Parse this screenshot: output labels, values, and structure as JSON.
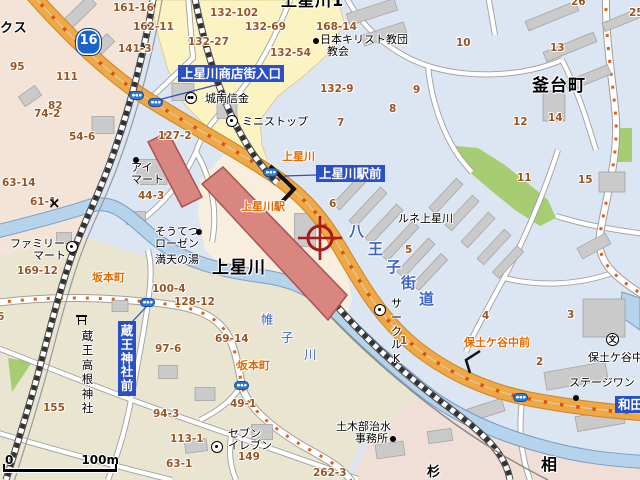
{
  "map": {
    "route_shield": {
      "number": "16"
    },
    "scale_bar": {
      "start": "0",
      "distance": "100m"
    },
    "place_names": [
      {
        "t": "上星川1",
        "x": 281,
        "y": -7,
        "fs": 16,
        "n": "place-kamihoshikawa-1"
      },
      {
        "t": "釜台町",
        "x": 532,
        "y": 78,
        "fs": 17,
        "n": "place-kamadaicho"
      },
      {
        "t": "上星川",
        "x": 212,
        "y": 260,
        "fs": 17,
        "n": "place-kamihoshikawa"
      },
      {
        "t": "相",
        "x": 541,
        "y": 457,
        "fs": 16,
        "n": "place-ai-partial"
      },
      {
        "t": "杉",
        "x": 427,
        "y": 466,
        "fs": 13,
        "n": "place-sugi-partial"
      },
      {
        "t": "クス",
        "x": 0,
        "y": 22,
        "fs": 13,
        "n": "place-kusu-partial"
      }
    ],
    "district_numbers": [
      {
        "t": "161-16",
        "x": 113,
        "y": 3
      },
      {
        "t": "162-11",
        "x": 133,
        "y": 22
      },
      {
        "t": "141-3",
        "x": 118,
        "y": 44
      },
      {
        "t": "132-102",
        "x": 210,
        "y": 8
      },
      {
        "t": "132-69",
        "x": 245,
        "y": 22
      },
      {
        "t": "132-27",
        "x": 188,
        "y": 37
      },
      {
        "t": "132-54",
        "x": 270,
        "y": 48
      },
      {
        "t": "168-14",
        "x": 316,
        "y": 22
      },
      {
        "t": "132-9",
        "x": 320,
        "y": 84
      },
      {
        "t": "95",
        "x": 10,
        "y": 62
      },
      {
        "t": "111",
        "x": 56,
        "y": 72
      },
      {
        "t": "82",
        "x": 48,
        "y": 101
      },
      {
        "t": "74-2",
        "x": 34,
        "y": 109
      },
      {
        "t": "54-6",
        "x": 69,
        "y": 132
      },
      {
        "t": "127-2",
        "x": 158,
        "y": 131
      },
      {
        "t": "26",
        "x": 571,
        "y": -3
      },
      {
        "t": "25",
        "x": 629,
        "y": 8
      },
      {
        "t": "10",
        "x": 456,
        "y": 38
      },
      {
        "t": "13",
        "x": 550,
        "y": 43
      },
      {
        "t": "9",
        "x": 413,
        "y": 85
      },
      {
        "t": "8",
        "x": 389,
        "y": 104
      },
      {
        "t": "7",
        "x": 337,
        "y": 118
      },
      {
        "t": "12",
        "x": 513,
        "y": 117
      },
      {
        "t": "14",
        "x": 548,
        "y": 113
      },
      {
        "t": "63-14",
        "x": 2,
        "y": 178
      },
      {
        "t": "44-3",
        "x": 138,
        "y": 191
      },
      {
        "t": "61-1",
        "x": 30,
        "y": 197
      },
      {
        "t": "6",
        "x": 329,
        "y": 199
      },
      {
        "t": "11",
        "x": 517,
        "y": 173
      },
      {
        "t": "15",
        "x": 578,
        "y": 175
      },
      {
        "t": "5",
        "x": 405,
        "y": 245
      },
      {
        "t": "169-12",
        "x": 17,
        "y": 266
      },
      {
        "t": "100-4",
        "x": 152,
        "y": 284
      },
      {
        "t": "128-12",
        "x": 174,
        "y": 297
      },
      {
        "t": "69-14",
        "x": 215,
        "y": 334
      },
      {
        "t": "97-6",
        "x": 155,
        "y": 344
      },
      {
        "t": "6",
        "x": -3,
        "y": 312
      },
      {
        "t": "155",
        "x": 43,
        "y": 403
      },
      {
        "t": "94-3",
        "x": 153,
        "y": 409
      },
      {
        "t": "113-1",
        "x": 170,
        "y": 434
      },
      {
        "t": "63-1",
        "x": 166,
        "y": 459
      },
      {
        "t": "149",
        "x": 238,
        "y": 452
      },
      {
        "t": "49-1",
        "x": 230,
        "y": 399
      },
      {
        "t": "1",
        "x": 400,
        "y": 336
      },
      {
        "t": "4",
        "x": 482,
        "y": 311
      },
      {
        "t": "3",
        "x": 567,
        "y": 310
      },
      {
        "t": "2",
        "x": 536,
        "y": 357
      },
      {
        "t": "262-3",
        "x": 313,
        "y": 468
      }
    ],
    "poi_labels": [
      {
        "t": "日本キリスト教団",
        "x": 320,
        "y": 34,
        "n": "poi-japan-christ-church"
      },
      {
        "t": "教会",
        "x": 327,
        "y": 46,
        "n": "poi-church-line2"
      },
      {
        "t": "城南信金",
        "x": 205,
        "y": 93,
        "n": "poi-jonan-shinkin-bank"
      },
      {
        "t": "ミニストップ",
        "x": 242,
        "y": 116,
        "n": "poi-ministop"
      },
      {
        "t": "アイ",
        "x": 131,
        "y": 162,
        "n": "poi-ai-mart-line1"
      },
      {
        "t": "マート",
        "x": 131,
        "y": 174,
        "n": "poi-ai-mart-line2"
      },
      {
        "t": "そうてつ",
        "x": 155,
        "y": 226,
        "n": "poi-sotetsu-rosen-line1"
      },
      {
        "t": "ローゼン",
        "x": 155,
        "y": 238,
        "n": "poi-sotetsu-rosen-line2"
      },
      {
        "t": "満天の湯",
        "x": 155,
        "y": 254,
        "n": "poi-manten-no-yu"
      },
      {
        "t": "ファミリー",
        "x": 10,
        "y": 238,
        "n": "poi-familymart-line1"
      },
      {
        "t": "マート",
        "x": 33,
        "y": 250,
        "n": "poi-familymart-line2"
      },
      {
        "t": "セブン",
        "x": 228,
        "y": 428,
        "n": "poi-seven-eleven-line1"
      },
      {
        "t": "イレブン",
        "x": 228,
        "y": 440,
        "n": "poi-seven-eleven-line2"
      },
      {
        "t": "ルネ上星川",
        "x": 398,
        "y": 213,
        "n": "poi-rune-kamihoshikawa"
      },
      {
        "t": "ステージワン",
        "x": 569,
        "y": 377,
        "n": "poi-stage-one"
      },
      {
        "t": "土木部治水",
        "x": 336,
        "y": 421,
        "n": "poi-civil-engineering-office-line1"
      },
      {
        "t": "事務所",
        "x": 355,
        "y": 433,
        "n": "poi-civil-engineering-office-line2"
      },
      {
        "t": "保土ケ谷中",
        "x": 588,
        "y": 352,
        "n": "poi-hodogaya-junior-high"
      },
      {
        "t": "蔵王高根神社",
        "x": 80,
        "y": 329,
        "v": true,
        "fs": 11.5,
        "n": "poi-zao-takane-shrine"
      },
      {
        "t": "サークルK",
        "x": 389,
        "y": 297,
        "v": true,
        "fs": 11,
        "n": "poi-circle-k"
      }
    ],
    "intersection_labels": [
      {
        "t": "上星川",
        "x": 282,
        "y": 151,
        "n": "intersection-kamihoshikawa"
      },
      {
        "t": "上星川駅",
        "x": 241,
        "y": 201,
        "n": "intersection-kamihoshikawa-sta"
      },
      {
        "t": "坂本町",
        "x": 92,
        "y": 272,
        "n": "intersection-sakamotocho-1"
      },
      {
        "t": "坂本町",
        "x": 237,
        "y": 360,
        "n": "intersection-sakamotocho-2"
      },
      {
        "t": "保土ケ谷中前",
        "x": 464,
        "y": 337,
        "n": "intersection-hodogayachu-mae"
      }
    ],
    "bus_stop_labels": [
      {
        "t": "上星川商店街入口",
        "x": 178,
        "y": 65,
        "n": "busstop-shotengai-iriguchi"
      },
      {
        "t": "上星川駅前",
        "x": 316,
        "y": 165,
        "n": "busstop-kamihoshikawa-ekimae"
      },
      {
        "t": "蔵王神社前",
        "x": 118,
        "y": 321,
        "v": true,
        "n": "busstop-zao-jinja-mae"
      },
      {
        "t": "和田",
        "x": 615,
        "y": 396,
        "n": "busstop-wada-partial"
      }
    ],
    "road_name_chars": [
      {
        "t": "八",
        "x": 349,
        "y": 224
      },
      {
        "t": "王",
        "x": 368,
        "y": 242
      },
      {
        "t": "子",
        "x": 386,
        "y": 260
      },
      {
        "t": "街",
        "x": 401,
        "y": 276
      },
      {
        "t": "道",
        "x": 419,
        "y": 292
      }
    ],
    "river_name_chars": [
      {
        "t": "帷",
        "x": 261,
        "y": 313
      },
      {
        "t": "子",
        "x": 281,
        "y": 331
      },
      {
        "t": "川",
        "x": 304,
        "y": 348
      }
    ],
    "icons": [
      {
        "type": "dot",
        "x": 313,
        "y": 38,
        "n": "church-dot-icon"
      },
      {
        "type": "shinkin",
        "x": 185,
        "y": 92,
        "n": "shinkin-bank-icon"
      },
      {
        "type": "store",
        "x": 226,
        "y": 115,
        "n": "ministop-store-icon"
      },
      {
        "type": "dot",
        "x": 133,
        "y": 157,
        "n": "ai-mart-dot-icon"
      },
      {
        "type": "dot",
        "x": 196,
        "y": 229,
        "n": "rosen-dot-icon"
      },
      {
        "type": "store",
        "x": 66,
        "y": 241,
        "n": "familymart-store-icon"
      },
      {
        "type": "store",
        "x": 211,
        "y": 441,
        "n": "seven-eleven-store-icon"
      },
      {
        "type": "store",
        "x": 374,
        "y": 304,
        "n": "circle-k-store-icon"
      },
      {
        "type": "dot",
        "x": 573,
        "y": 395,
        "n": "stage-one-dot-icon"
      },
      {
        "type": "dot",
        "x": 390,
        "y": 436,
        "n": "civil-office-dot-icon"
      },
      {
        "type": "school",
        "t": "文",
        "x": 606,
        "y": 333,
        "n": "school-icon"
      },
      {
        "type": "torii",
        "x": 76,
        "y": 315,
        "n": "torii-shrine-icon"
      },
      {
        "type": "police",
        "t": "×",
        "x": 48,
        "y": 196,
        "n": "police-x-icon"
      }
    ],
    "signals": [
      {
        "x": 136,
        "y": 95
      },
      {
        "x": 155,
        "y": 102
      },
      {
        "x": 270,
        "y": 172
      },
      {
        "x": 147,
        "y": 302
      },
      {
        "x": 241,
        "y": 385
      },
      {
        "x": 520,
        "y": 397
      }
    ]
  },
  "colors": {
    "road_orange": "#f0a843",
    "road_dot": "#dc5010",
    "river": "#b5d3ea",
    "river_edge": "#7a9cc4",
    "station_red": "#d98580",
    "label_blue": "#2a50c3",
    "inter_orange": "#e56a00",
    "num_brown": "#9a5420",
    "roadname_blue": "#3c64c8",
    "green": "#a6cd72",
    "crosshair": "#a81a1a",
    "shield_blue": "#1a63c8"
  }
}
